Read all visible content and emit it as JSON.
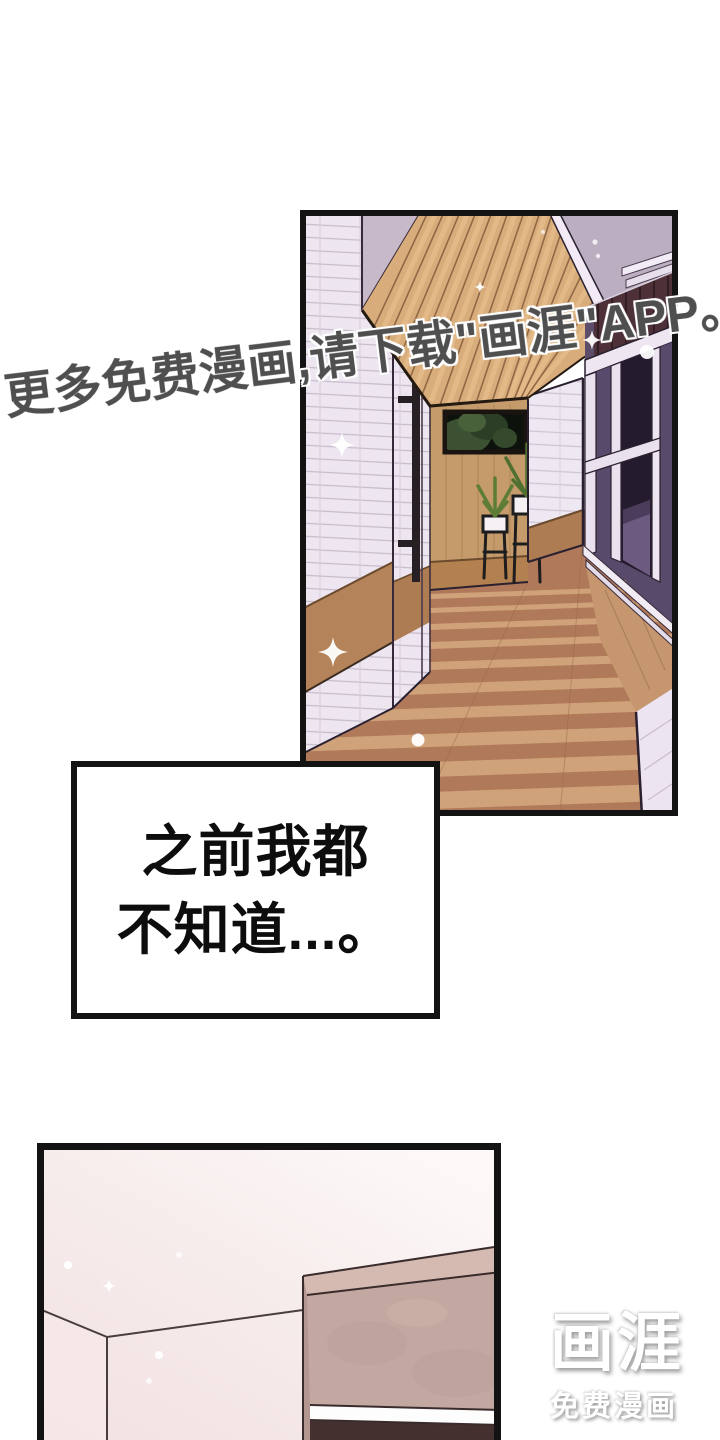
{
  "watermark": {
    "text": "更多免费漫画,请下载\"画涯\"APP。",
    "color": "#4f4f4f"
  },
  "speech_bubble": {
    "lines": [
      "之前我都",
      "不知道...。"
    ]
  },
  "logo": {
    "brand": "画涯",
    "tagline": "免费漫画"
  },
  "colors": {
    "panel_border": "#131313",
    "brick_wall": "#ece5ef",
    "ceiling_wood": "#d8ad7b",
    "back_wall_wood": "#c59b6b",
    "floor_wood": "#b0795a",
    "floor_sun_stripe": "#d4a77e",
    "door_glass_purple": "#584a6b",
    "transom_maroon": "#4e3138",
    "upper_wall_lavender": "#bbaec0",
    "bedroom_wall_pink": "#f3e5e5",
    "cabinet_mauve": "#c3a8a1",
    "cabinet_dark_base": "#44302e"
  }
}
